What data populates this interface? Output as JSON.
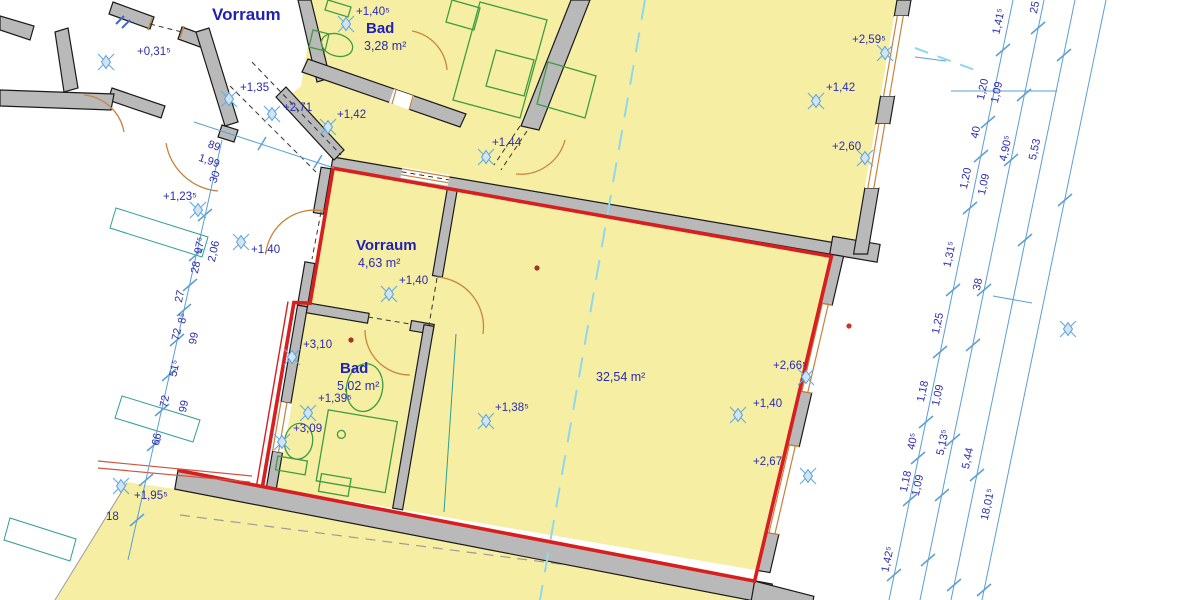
{
  "title": "Wohnungs-Grundriss (floor plan with selected apartment)",
  "colors": {
    "room_fill_yellow": "#f6efa3",
    "wall_gray": "#b9b9b9",
    "selection_red": "#d81f1f",
    "dimension_blue": "#2b2bb0",
    "marker_blue": "#5b9fd4",
    "fixture_green": "#3f9b3f",
    "door_orange": "#c8843c",
    "section_cyan": "#8fd8ec"
  },
  "rooms": [
    {
      "name": "Vorraum",
      "area": ""
    },
    {
      "name": "Bad",
      "area": "3,28 m²"
    },
    {
      "name": "Vorraum",
      "area": "4,63 m²"
    },
    {
      "name": "Bad",
      "area": "5,02 m²"
    },
    {
      "name": "",
      "area": "32,54 m²"
    }
  ],
  "elevations": [
    "+0,31⁵",
    "+1,35",
    "+2,71",
    "+1,42",
    "+1,40⁵",
    "+1,44",
    "+2,59⁵",
    "+1,42",
    "+2,60",
    "+1,23⁵",
    "+1,40",
    "+1,40",
    "+3,10",
    "+1,39⁵",
    "+3,09",
    "+1,38⁵",
    "+1,40",
    "+2,66⁵",
    "+2,67",
    "+1,95⁵",
    "18"
  ],
  "dims_right": [
    "1,41⁵",
    "1,20",
    "40",
    "1,20",
    "1,31⁵",
    "1,25",
    "1,18",
    "40⁵",
    "1,18",
    "1,42⁵",
    "1,09",
    "4,90⁵",
    "1,09",
    "38",
    "1,09",
    "5,13⁵",
    "1,09",
    "25",
    "5,53",
    "5,44",
    "18,01⁵"
  ],
  "dims_left": [
    "97⁵",
    "2,06",
    "28",
    "27",
    "8⁵",
    "72",
    "99",
    "51⁵",
    "72",
    "99",
    "66"
  ],
  "dims_door": [
    "89",
    "1,99",
    "30"
  ]
}
